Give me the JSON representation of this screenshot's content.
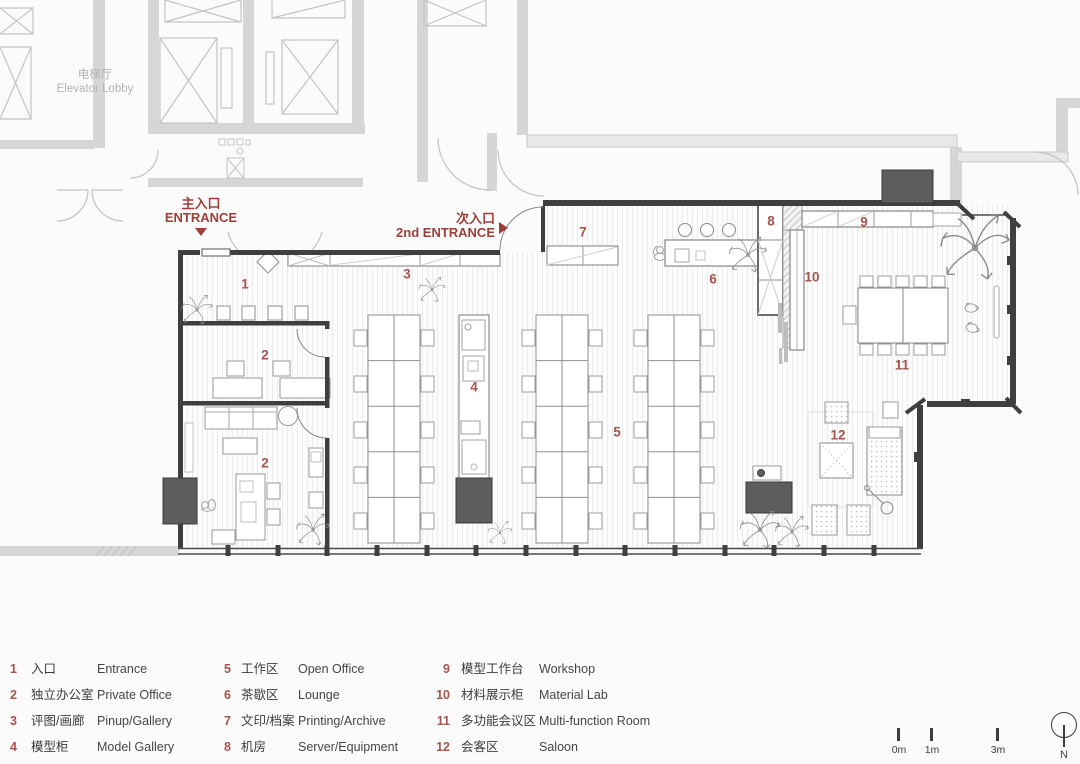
{
  "plan": {
    "elevator_lobby": {
      "cn": "电梯厅",
      "en": "Elevator Lobby"
    },
    "main_entrance": {
      "cn": "主入口",
      "en": "ENTRANCE"
    },
    "second_entrance": {
      "cn": "次入口",
      "en": "2nd ENTRANCE"
    },
    "markers": [
      {
        "label": "1"
      },
      {
        "label": "2"
      },
      {
        "label": "2"
      },
      {
        "label": "3"
      },
      {
        "label": "4"
      },
      {
        "label": "5"
      },
      {
        "label": "6"
      },
      {
        "label": "7"
      },
      {
        "label": "8"
      },
      {
        "label": "9"
      },
      {
        "label": "10"
      },
      {
        "label": "11"
      },
      {
        "label": "12"
      }
    ]
  },
  "legend": {
    "items": [
      {
        "num": "1",
        "cn": "入口",
        "en": "Entrance"
      },
      {
        "num": "2",
        "cn": "独立办公室",
        "en": "Private Office"
      },
      {
        "num": "3",
        "cn": "评图/画廊",
        "en": "Pinup/Gallery"
      },
      {
        "num": "4",
        "cn": "模型柜",
        "en": "Model Gallery"
      },
      {
        "num": "5",
        "cn": "工作区",
        "en": "Open Office"
      },
      {
        "num": "6",
        "cn": "茶歇区",
        "en": "Lounge"
      },
      {
        "num": "7",
        "cn": "文印/档案",
        "en": "Printing/Archive"
      },
      {
        "num": "8",
        "cn": "机房",
        "en": "Server/Equipment"
      },
      {
        "num": "9",
        "cn": "模型工作台",
        "en": "Workshop"
      },
      {
        "num": "10",
        "cn": "材料展示柜",
        "en": "Material Lab"
      },
      {
        "num": "11",
        "cn": "多功能会议区",
        "en": "Multi-function Room"
      },
      {
        "num": "12",
        "cn": "会客区",
        "en": "Saloon"
      }
    ]
  },
  "scale_bar": {
    "ticks": [
      "0m",
      "1m",
      "3m"
    ],
    "north": "N"
  },
  "colors": {
    "accent_red": "#9d3f38",
    "marker_red": "#a6544c",
    "wall_dark": "#3f3f3f",
    "column_fill": "#5d5d5d",
    "gray_structure": "#c9c9c9",
    "lobby_text": "#b3b3b3"
  }
}
